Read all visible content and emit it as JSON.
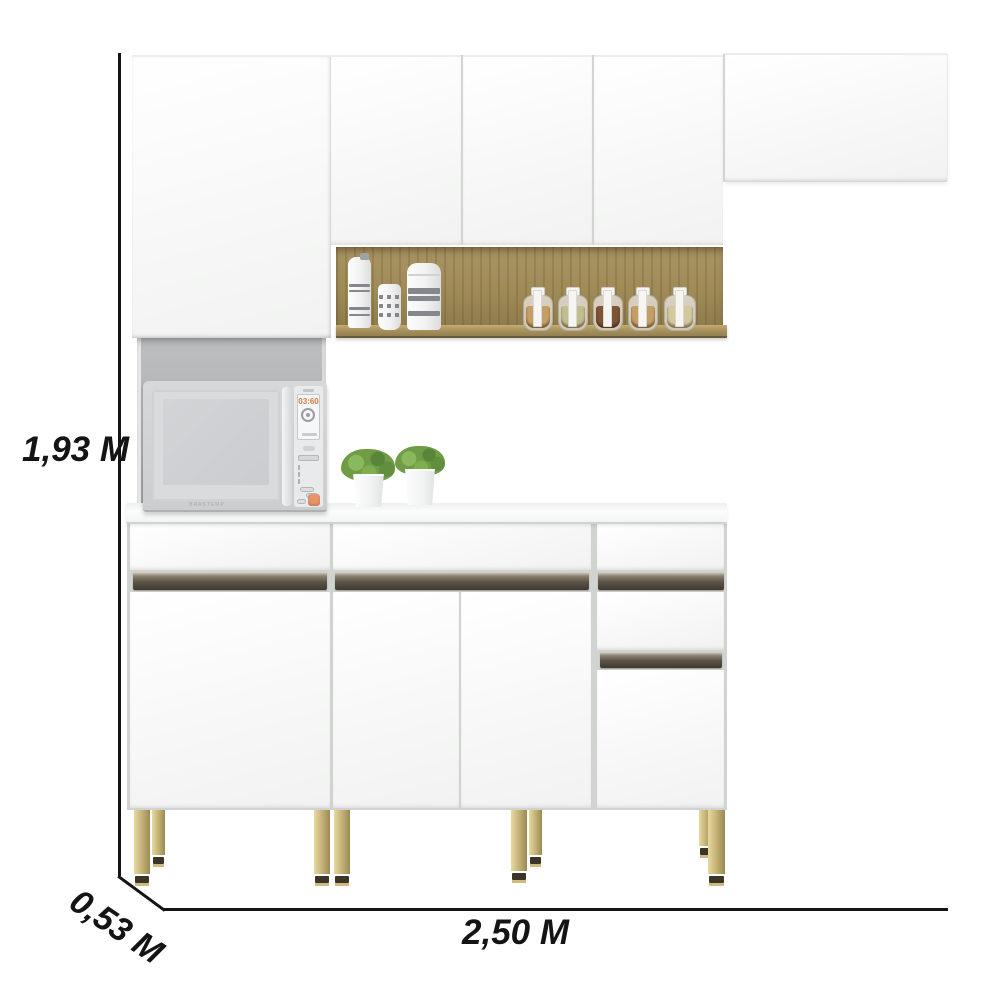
{
  "dimensions": {
    "height": "1,93 M",
    "depth": "0,53 M",
    "width": "2,50 M"
  },
  "microwave": {
    "display_time": "03:60",
    "brand": "BRASTEMP"
  },
  "shelf": {
    "canisters_count": 3,
    "spice_jars": [
      {
        "color": "#c59e66"
      },
      {
        "color": "#c2bd8e"
      },
      {
        "color": "#7d5434"
      },
      {
        "color": "#c59e66"
      },
      {
        "color": "#d3c79c"
      }
    ]
  },
  "colors": {
    "cabinet_white": "#f9faf9",
    "wood": "#a08b57",
    "handle_bronze": "#5c5547",
    "leg_gold": "#c8b67a",
    "niche_gray": "#b2b4b6",
    "start_button_accent": "#e8956a",
    "dimension_line": "#141414"
  },
  "plants_count": 2
}
